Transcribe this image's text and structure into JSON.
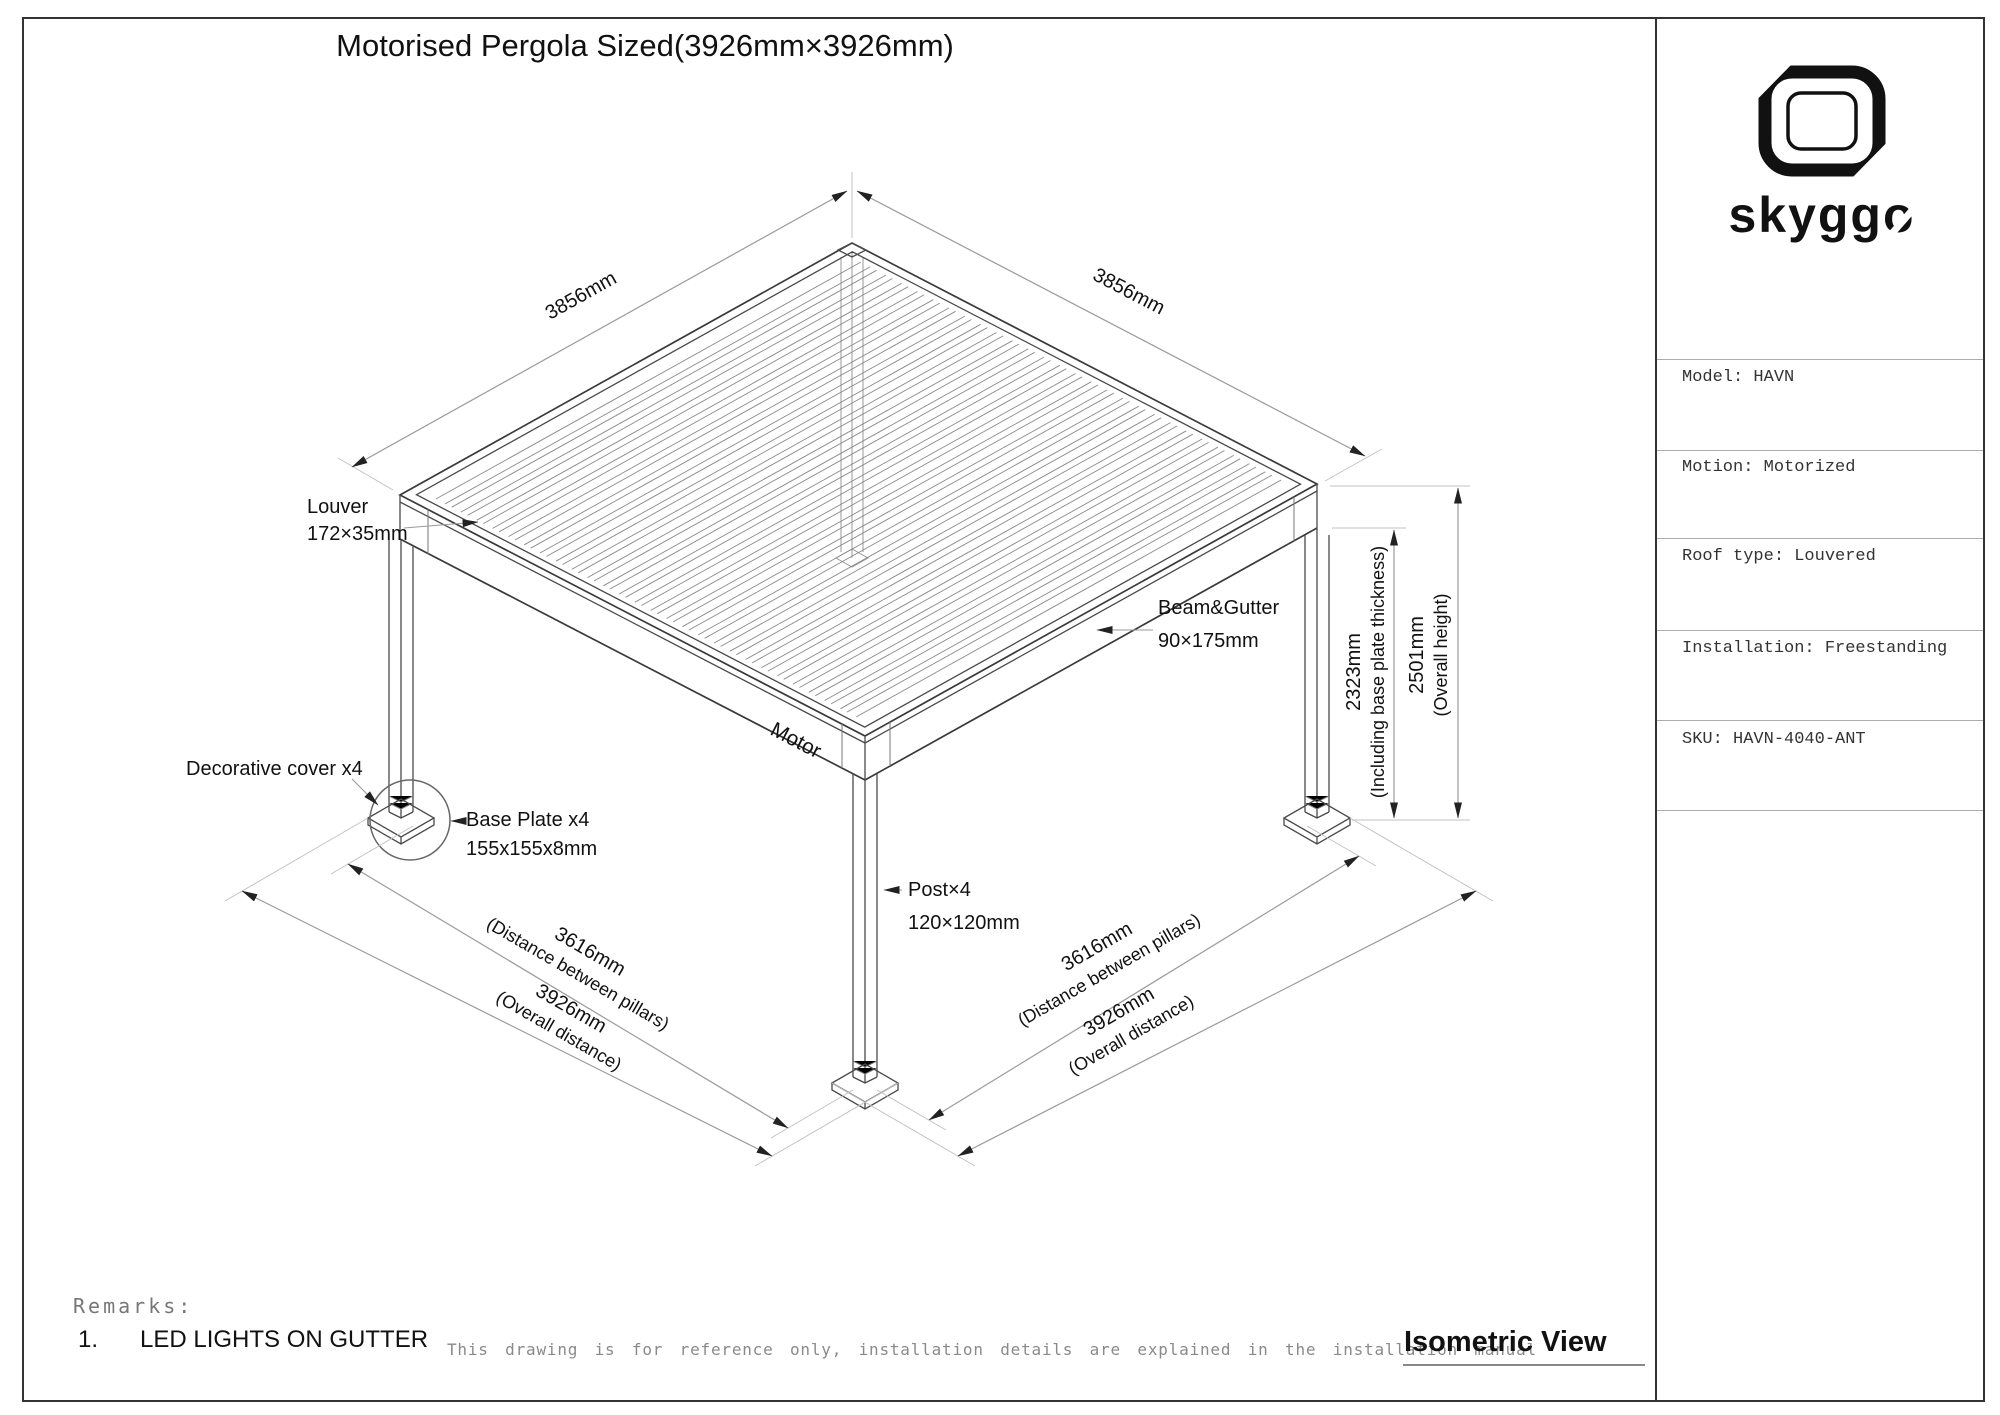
{
  "title": "Motorised Pergola Sized(3926mm×3926mm)",
  "brand": {
    "name": "skyggo",
    "color": "#111111"
  },
  "sidebar": {
    "specs": [
      "Model: HAVN",
      "Motion: Motorized",
      "Roof type: Louvered",
      "Installation: Freestanding",
      "SKU: HAVN-4040-ANT"
    ]
  },
  "drawing": {
    "dims": {
      "roof_edge_left": "3856mm",
      "roof_edge_right": "3856mm",
      "post_height": "2323mm",
      "post_height_note": "(Including base plate thickness)",
      "overall_height": "2501mm",
      "overall_height_note": "(Overall height)",
      "pillar_span_left": "3616mm",
      "pillar_span_left_note": "(Distance between pillars)",
      "overall_span_left": "3926mm",
      "overall_span_left_note": "(Overall distance)",
      "pillar_span_right": "3616mm",
      "pillar_span_right_note": "(Distance between pillars)",
      "overall_span_right": "3926mm",
      "overall_span_right_note": "(Overall distance)"
    },
    "labels": {
      "louver_name": "Louver",
      "louver_size": "172×35mm",
      "beam_name": "Beam&Gutter",
      "beam_size": "90×175mm",
      "post_name": "Post×4",
      "post_size": "120×120mm",
      "base_plate_name": "Base Plate x4",
      "base_plate_size": "155x155x8mm",
      "decorative_cover": "Decorative cover x4",
      "motor": "Motor"
    }
  },
  "footer": {
    "remarks_title": "Remarks:",
    "remark_number": "1.",
    "remark_text": "LED LIGHTS ON GUTTER",
    "disclaimer": "This drawing is for reference only, installation details are explained in the installation manual",
    "view_label": "Isometric View"
  }
}
